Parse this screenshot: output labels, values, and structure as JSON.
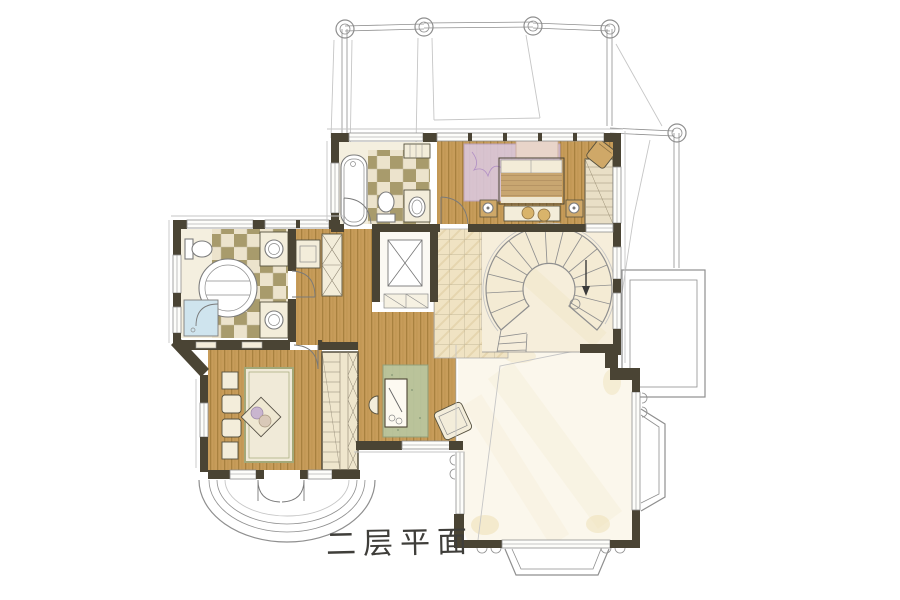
{
  "title": {
    "text": "二层平面"
  },
  "palette": {
    "paper": "#ffffff",
    "ink": "#3f3e3a",
    "wall": "#4a4434",
    "line_gray": "#8f8f8f",
    "sketch_gray": "#c6c6c6",
    "wood": "#c79c5a",
    "wood_grain": "#a8813f",
    "tile_olive": "#a89b6c",
    "tile_cream": "#ece3cc",
    "marble": "#f0e3c3",
    "stair_cream": "#f6eedb",
    "void_cream": "#fbf7ec",
    "rug_purple": "#dccae4",
    "rug_green": "#b9c7a0",
    "rug_cream": "#f0ead8",
    "shower_blue": "#cfe4ee",
    "furniture_cream": "#f3edda",
    "furniture_tan": "#d9b46b"
  }
}
